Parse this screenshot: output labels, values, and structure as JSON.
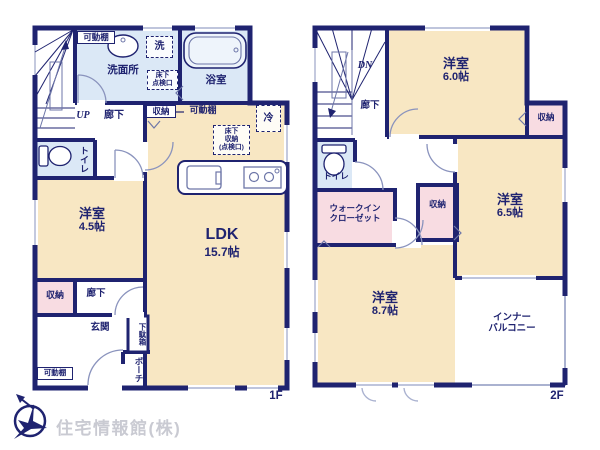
{
  "colors": {
    "wall": "#1f2370",
    "room_tatami": "#f8e7c3",
    "wet_area": "#dbe8f6",
    "closet_pink": "#f8dce2",
    "window_line": "#aab2d0",
    "logo_text": "#c9cad2"
  },
  "f1": {
    "floor_label": "1F",
    "kadoudana_top": "可動棚",
    "sentaku": "洗",
    "senmenjo": "洗面所",
    "yukashita_tenken_1": "床下",
    "yukashita_tenken_2": "点検口",
    "yokushitsu": "浴室",
    "up": "UP",
    "rouka_up": "廊下",
    "toilet": "トイレ",
    "youshitsu_name": "洋室",
    "youshitsu_size": "4.5帖",
    "shuunou_ldk": "収納",
    "kadoudana_ldk": "可動棚",
    "rei": "冷",
    "yukashita_shuunou_1": "床下",
    "yukashita_shuunou_2": "収納",
    "yukashita_shuunou_3": "(点検口)",
    "ldk_name": "LDK",
    "ldk_size": "15.7帖",
    "shuunou": "収納",
    "rouka_lower": "廊下",
    "genkan": "玄関",
    "getabako": "下駄箱",
    "porch": "ポーチ",
    "kadoudana_bottom": "可動棚"
  },
  "f2": {
    "floor_label": "2F",
    "dn": "DN",
    "rouka": "廊下",
    "y60_name": "洋室",
    "y60_size": "6.0帖",
    "shuunou_right": "収納",
    "toilet": "トイレ",
    "wic_1": "ウォークイン",
    "wic_2": "クローゼット",
    "shuunou_mid": "収納",
    "y65_name": "洋室",
    "y65_size": "6.5帖",
    "y87_name": "洋室",
    "y87_size": "8.7帖",
    "balcony_1": "インナー",
    "balcony_2": "バルコニー"
  },
  "logo": {
    "company": "住宅情報館(株)"
  }
}
